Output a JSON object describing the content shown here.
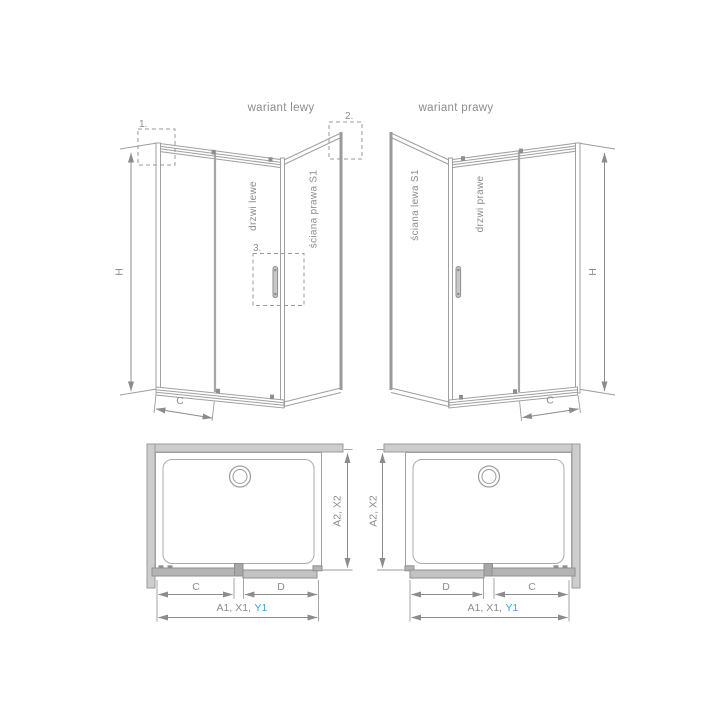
{
  "left_variant": {
    "title": "wariant lewy",
    "door_label": "drzwi lewe",
    "wall_label": "ściana prawa S1",
    "callout_1": "1.",
    "callout_2": "2.",
    "callout_3": "3.",
    "dim_height": "H",
    "dim_door": "C"
  },
  "right_variant": {
    "title": "wariant prawy",
    "wall_label": "ściana lewa S1",
    "door_label": "drzwi prawe",
    "dim_height": "H",
    "dim_door": "C"
  },
  "left_plan": {
    "dim_depth": "A2, X2",
    "dim_door": "C",
    "dim_fixed": "D",
    "dim_total": "A1, X1,",
    "dim_total_accent": "Y1"
  },
  "right_plan": {
    "dim_depth": "A2, X2",
    "dim_fixed": "D",
    "dim_door": "C",
    "dim_total": "A1, X1,",
    "dim_total_accent": "Y1"
  },
  "colors": {
    "structure_line": "#a0a0a0",
    "dimension_line": "#8c8c8c",
    "label_text": "#8c8c8c",
    "accent_cyan": "#29abe2",
    "wall_fill": "#cdcdcd",
    "profile_fill": "#b4b4b4"
  }
}
